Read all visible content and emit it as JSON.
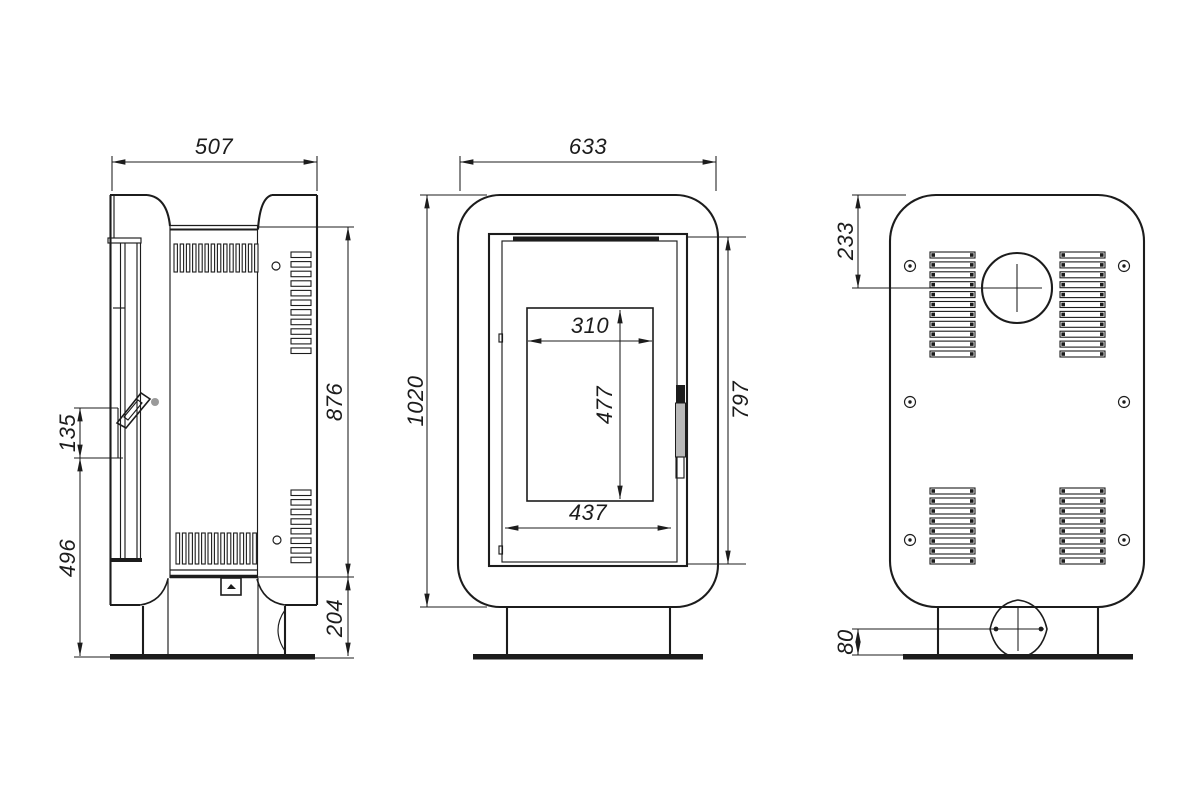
{
  "drawing": {
    "colors": {
      "line": "#1c1c1c",
      "background": "#ffffff",
      "handle_dot": "#9a9a9a"
    },
    "views": {
      "side": {
        "dims": {
          "depth": "507",
          "body_height": "876",
          "handle_span": "135",
          "handle_to_floor": "496",
          "plinth_height": "204"
        }
      },
      "front": {
        "dims": {
          "width": "633",
          "overall_height": "1020",
          "glass_width": "310",
          "glass_height": "477",
          "door_inner_width": "437",
          "door_height": "797"
        }
      },
      "back": {
        "dims": {
          "flue_centre_from_top": "233",
          "air_inlet_centre_from_floor": "80"
        }
      }
    }
  }
}
